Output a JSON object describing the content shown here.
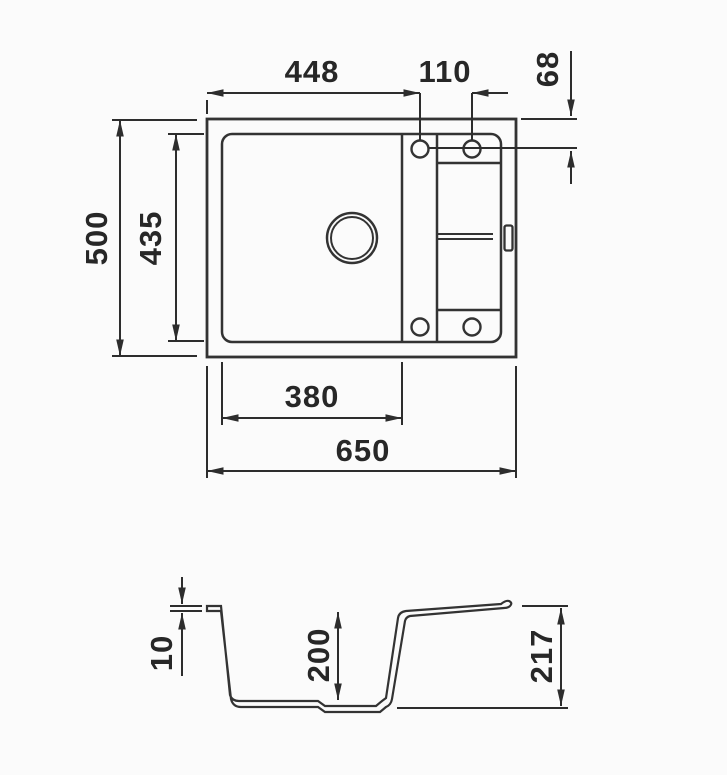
{
  "drawing": {
    "kind": "sink technical drawing",
    "background": "#fbfbfb",
    "line_color": "#333333",
    "text_color": "#272727"
  },
  "plan_view": {
    "dims": {
      "overall_width": "650",
      "overall_depth": "500",
      "bowl_inner_width": "380",
      "bowl_inner_depth": "435",
      "tap_hole_offset_x": "448",
      "tap_hole_spacing": "110",
      "tap_hole_offset_y": "68"
    }
  },
  "section_view": {
    "dims": {
      "rim_thickness": "10",
      "bowl_depth": "200",
      "overall_height": "217"
    }
  }
}
